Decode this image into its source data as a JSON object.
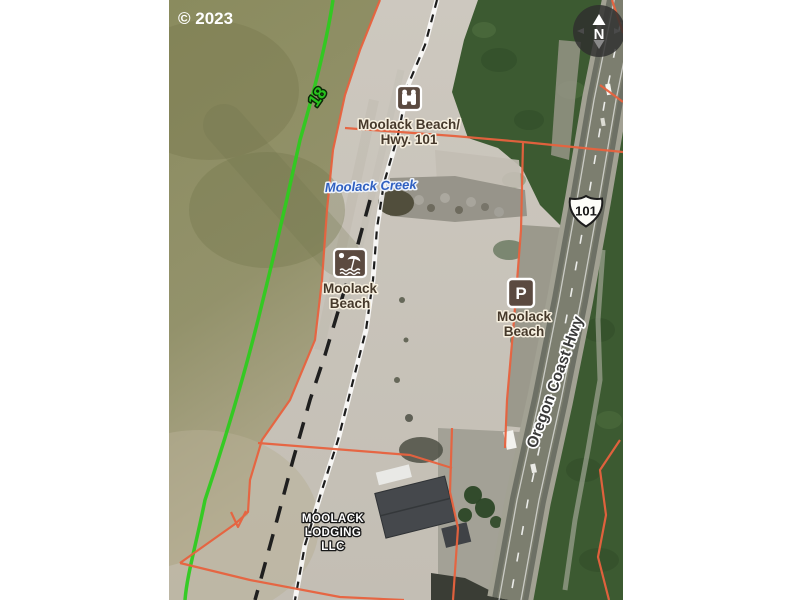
{
  "map": {
    "copyright": "© 2023",
    "compass": {
      "north_label": "N"
    },
    "mile_marker": {
      "value": "18"
    },
    "highway_shield": {
      "route_number": "101"
    },
    "labels": {
      "viewpoint": {
        "line1": "Moolack Beach/",
        "line2": "Hwy. 101"
      },
      "creek": {
        "name": "Moolack Creek"
      },
      "beach_access": {
        "line1": "Moolack",
        "line2": "Beach"
      },
      "parking": {
        "glyph": "P",
        "line1": "Moolack",
        "line2": "Beach"
      },
      "road_name": "Oregon Coast Hwy",
      "lodging": {
        "line1": "MOOLACK",
        "line2": "LODGING",
        "line3": "LLC"
      }
    },
    "colors": {
      "parcel_boundary": "#e8623e",
      "milepost_line": "#2ecb1f",
      "ocean": "#8b8c5f",
      "sand": "#cac5bc",
      "vegetation": "#3c5a31",
      "road_surface": "#73756a",
      "poi_icon_background": "#5b4a40",
      "creek_label": "#2f5fc0"
    }
  }
}
